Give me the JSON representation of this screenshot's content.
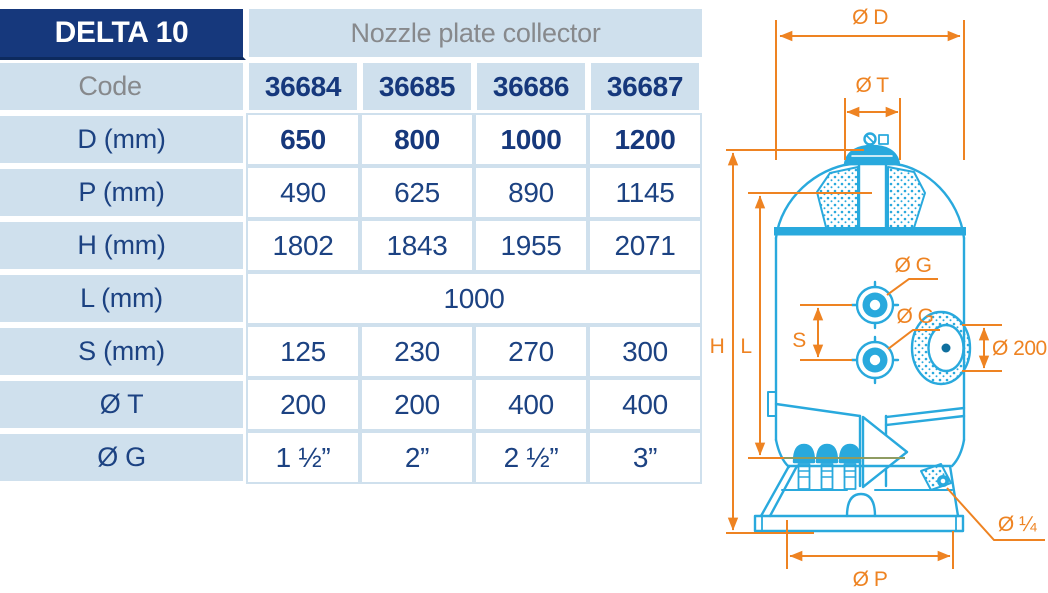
{
  "header": {
    "model": "DELTA 10",
    "product": "Nozzle plate collector"
  },
  "table": {
    "code_row": {
      "label": "Code",
      "values": [
        "36684",
        "36685",
        "36686",
        "36687"
      ]
    },
    "rows": [
      {
        "label": "D (mm)",
        "values": [
          "650",
          "800",
          "1000",
          "1200"
        ]
      },
      {
        "label": "P (mm)",
        "values": [
          "490",
          "625",
          "890",
          "1145"
        ]
      },
      {
        "label": "H (mm)",
        "values": [
          "1802",
          "1843",
          "1955",
          "2071"
        ]
      },
      {
        "label": "L (mm)",
        "values": [
          "1000"
        ]
      },
      {
        "label": "S (mm)",
        "values": [
          "125",
          "230",
          "270",
          "300"
        ]
      },
      {
        "label": "Ø T",
        "values": [
          "200",
          "200",
          "400",
          "400"
        ]
      },
      {
        "label": "Ø G",
        "values": [
          "1 ½”",
          "2”",
          "2 ½”",
          "3”"
        ]
      }
    ]
  },
  "diagram": {
    "labels": {
      "diameter_d": "Ø D",
      "diameter_t": "Ø T",
      "height_h": "H",
      "length_l": "L",
      "spacing_s": "S",
      "port_g_top": "Ø G",
      "port_g_bottom": "Ø G",
      "flange_200": "Ø 200",
      "drain_quarter": "Ø ¼",
      "diameter_p": "Ø P"
    }
  },
  "colors": {
    "navy": "#16387c",
    "light_blue": "#cfe0ed",
    "text_navy": "#1c4282",
    "text_gray": "#87898c",
    "drawing_cyan": "#29a9dd",
    "dimension_orange": "#ee8322"
  }
}
